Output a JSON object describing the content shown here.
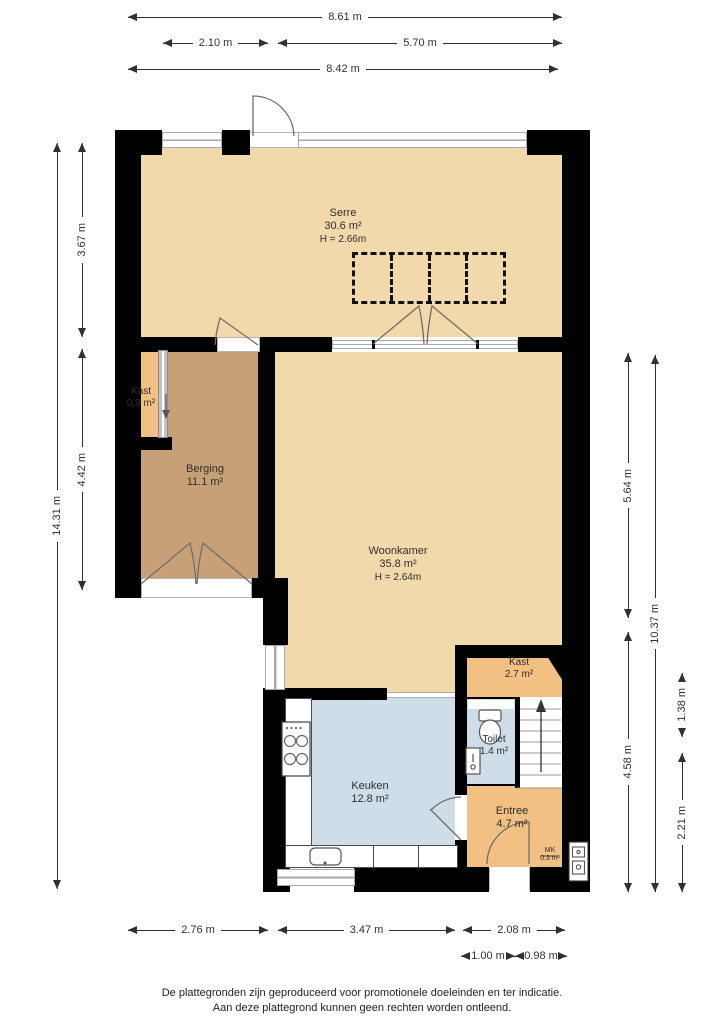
{
  "colors": {
    "wall": "#000000",
    "floor_cream": "#f2d9ab",
    "floor_orange": "#f2c083",
    "floor_brown": "#c7a077",
    "floor_blue": "#cfdde9",
    "window_gray": "#a8a8a8",
    "dim": "#303030"
  },
  "rooms": {
    "serre": {
      "name": "Serre",
      "area": "30.6 m²",
      "height": "H = 2.66m"
    },
    "kast1": {
      "name": "Kast",
      "area": "0.9 m²"
    },
    "berging": {
      "name": "Berging",
      "area": "11.1 m²"
    },
    "woonkamer": {
      "name": "Woonkamer",
      "area": "35.8 m²",
      "height": "H = 2.64m"
    },
    "kast2": {
      "name": "Kast",
      "area": "2.7 m²"
    },
    "toilet": {
      "name": "Toilet",
      "area": "1.4 m²"
    },
    "keuken": {
      "name": "Keuken",
      "area": "12.8 m²"
    },
    "entree": {
      "name": "Entree",
      "area": "4.7 m²"
    },
    "meterkast": {
      "name": "MK",
      "area": "0.3 m²"
    }
  },
  "dimensions": {
    "top": {
      "total": "8.61 m",
      "left_segment": "2.10 m",
      "right_segment": "5.70 m",
      "inner": "8.42 m"
    },
    "left": {
      "total": "14.31 m",
      "serre": "3.67 m",
      "berging": "4.42 m"
    },
    "right": {
      "woonkamer": "5.64 m",
      "lower": "4.58 m",
      "total": "10.37 m",
      "kast": "1.38 m",
      "entree": "2.21 m"
    },
    "bottom": {
      "berging": "2.76 m",
      "keuken": "3.47 m",
      "entree": "2.08 m",
      "sub_left": "1.00 m",
      "sub_right": "0.98 m"
    }
  },
  "footer": {
    "line1": "De plattegronden zijn geproduceerd voor promotionele doeleinden en ter indicatie.",
    "line2": "Aan deze plattegrond kunnen geen rechten worden ontleend."
  }
}
